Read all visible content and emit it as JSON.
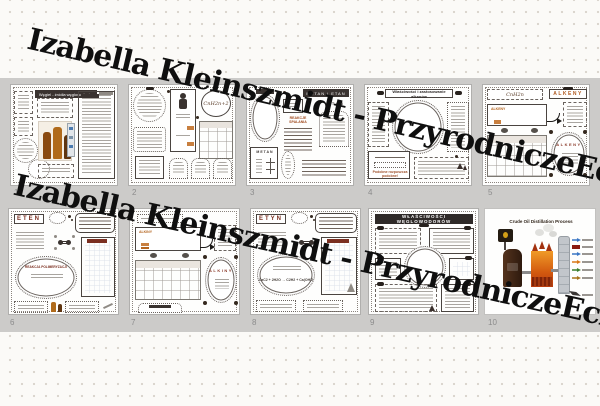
{
  "watermark": {
    "text": "Izabella Kleinszmidt - PrzyrodniczeEcho",
    "color": "#0f0f0f"
  },
  "palette": {
    "band": "#cccbc9",
    "dot": "#d9d4cc",
    "accent_orange": "#b4641e",
    "title_red": "#7b2f20",
    "dark_ink": "#3a3330",
    "furnace_orange": "#e8851c",
    "furnace_red": "#b83c0e",
    "fraction_blue": "#3a76c4",
    "fraction_darkred": "#8b1a10",
    "fraction_orange": "#d97818",
    "fraction_green": "#3a7d2c",
    "fraction_gold": "#a8741a"
  },
  "pages": [
    {
      "number": "1",
      "title": "Węgiel - źródła węglowodorów"
    },
    {
      "number": "2",
      "formula": "CnH2n+2"
    },
    {
      "number": "3",
      "banner": "METAN i ETAN",
      "label_etan": "ETAN",
      "label_metan": "METAN",
      "section": "REAKCJE SPALANIA"
    },
    {
      "number": "4",
      "title": "Właściwości i zastosowanie alkanów",
      "note": "Podobne rozpuszcza podobne!"
    },
    {
      "number": "5",
      "header": "ALKENY",
      "formula": "CnH2n",
      "keyword": "ALKENY",
      "oval_title": "ALKENY"
    },
    {
      "number": "6",
      "title": "ETEN",
      "oval_header": "REAKCJA POLIMERYZACJI"
    },
    {
      "number": "7",
      "keyword": "ALKINY",
      "oval_title": "ALKINY"
    },
    {
      "number": "8",
      "title": "ETYN",
      "equation": "CaC2 + 2H2O → C2H2 + Ca(OH)2"
    },
    {
      "number": "9",
      "banner": "WŁAŚCIWOŚCI WĘGLOWODORÓW"
    },
    {
      "number": "10",
      "title": "Crude Oil Distillation Process"
    }
  ]
}
